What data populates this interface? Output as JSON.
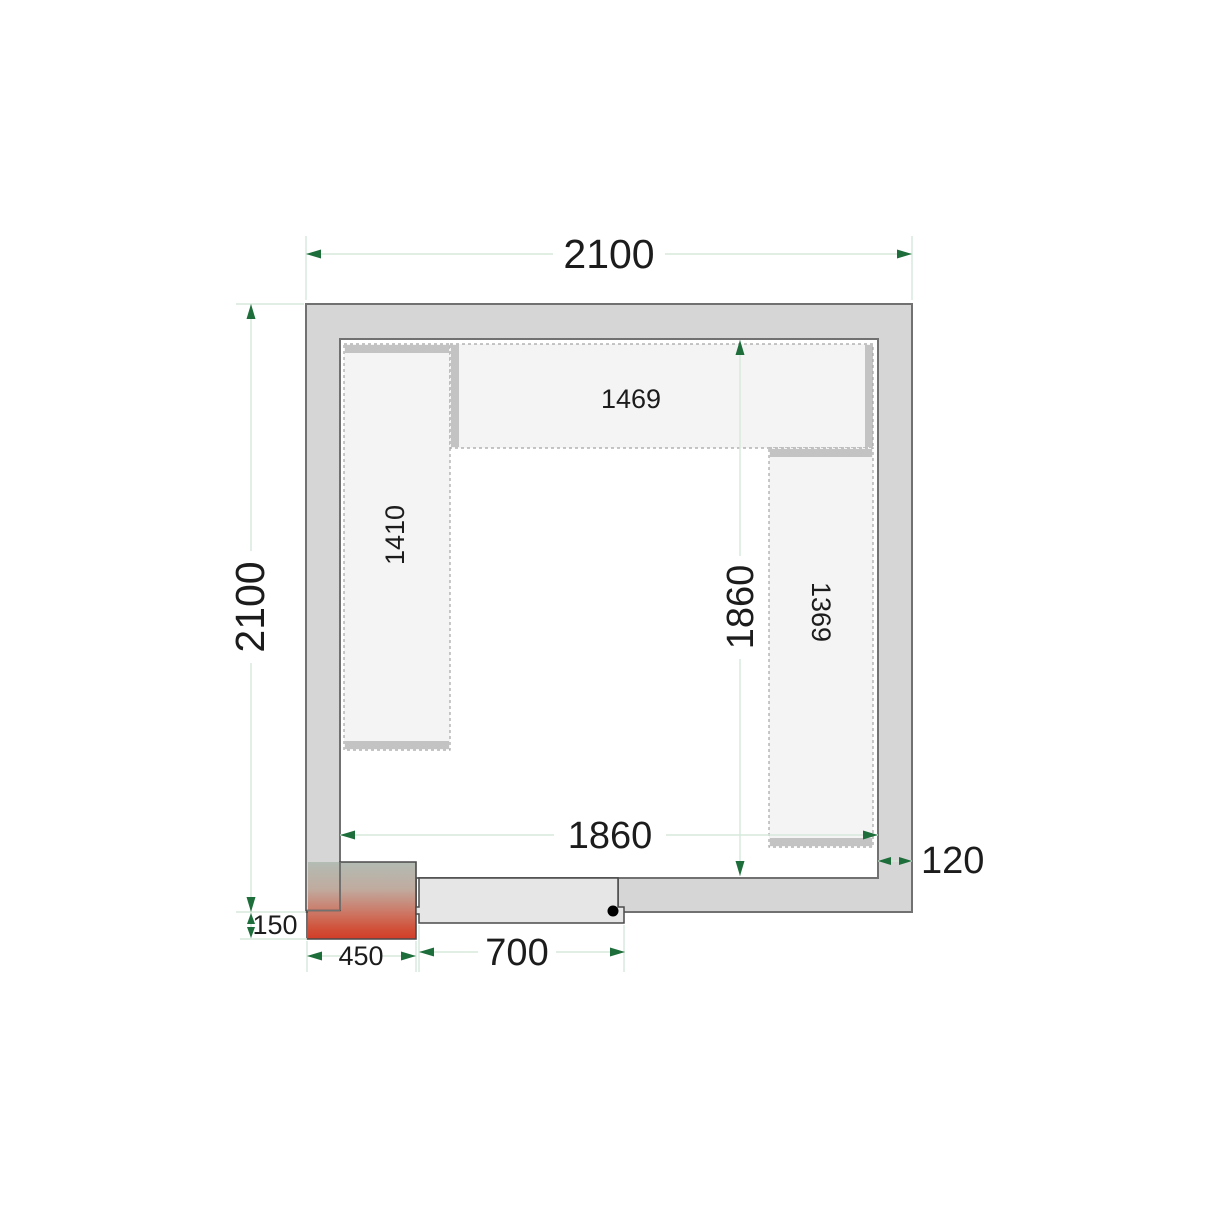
{
  "labels": {
    "outer_width": "2100",
    "outer_height": "2100",
    "inner_height": "1860",
    "inner_width": "1860",
    "top_shelf_length": "1469",
    "left_shelf_length": "1410",
    "right_shelf_length": "1369",
    "wall_thickness": "120",
    "unit_overhang": "150",
    "unit_width": "450",
    "door_width": "700"
  },
  "colors": {
    "wall_fill": "#d6d6d6",
    "wall_border": "#717171",
    "shelf_fill": "#f4f4f4",
    "shelf_edge_bar": "#c3c3c3",
    "shelf_dash_border": "#a5a5a5",
    "door_fill": "#e6e6e6",
    "dimension_line": "#d6e8db",
    "dimension_arrow": "#1d6e3a",
    "unit_gradient_top": "#b3bcb4",
    "unit_gradient_mid": "#c9a593",
    "unit_gradient_bottom": "#d23c28",
    "label_text": "#1c1c1c"
  }
}
